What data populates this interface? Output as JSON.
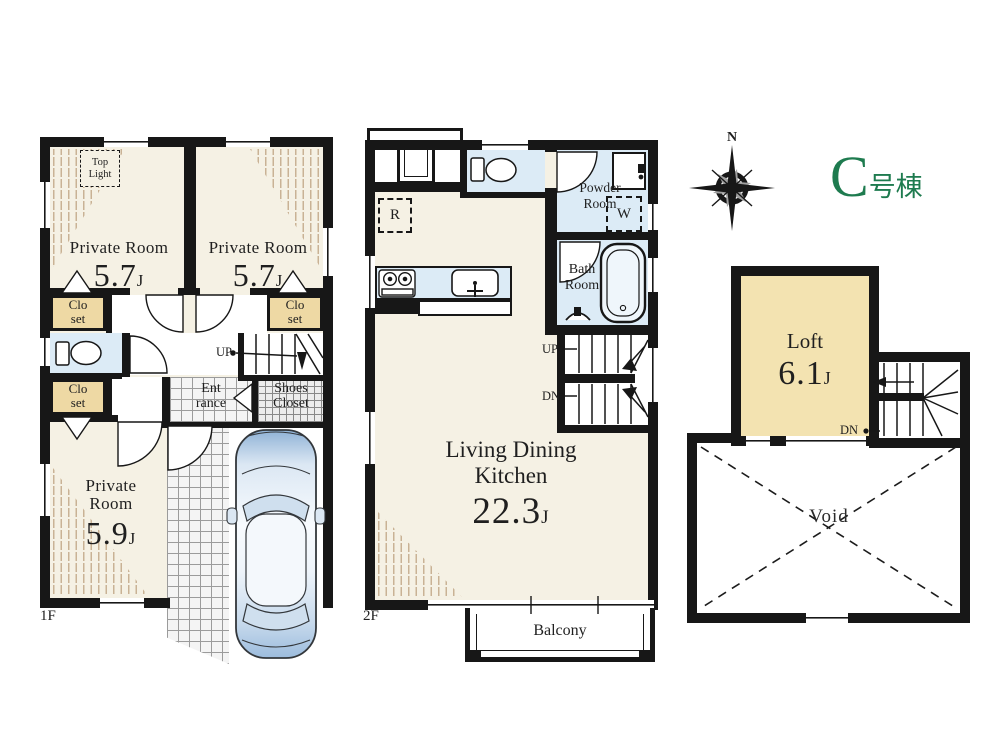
{
  "building_label": {
    "letter": "C",
    "suffix": "号棟"
  },
  "compass": {
    "north": "N"
  },
  "floor1": {
    "label": "1F",
    "private_room_a": {
      "name": "Private Room",
      "size": "5.7",
      "unit": "J"
    },
    "private_room_b": {
      "name": "Private Room",
      "size": "5.7",
      "unit": "J"
    },
    "private_room_c": {
      "name_line1": "Private",
      "name_line2": "Room",
      "size": "5.9",
      "unit": "J"
    },
    "top_light": {
      "line1": "Top",
      "line2": "Light"
    },
    "closet": {
      "line1": "Clo",
      "line2": "set"
    },
    "entrance": {
      "line1": "Ent",
      "line2": "rance"
    },
    "shoes_closet": {
      "line1": "Shoes",
      "line2": "Closet"
    },
    "stairs_up": "UP"
  },
  "floor2": {
    "label": "2F",
    "ldk": {
      "name_line1": "Living Dining",
      "name_line2": "Kitchen",
      "size": "22.3",
      "unit": "J"
    },
    "powder_room": {
      "line1": "Powder",
      "line2": "Room"
    },
    "bath_room": {
      "line1": "Bath",
      "line2": "Room"
    },
    "refrigerator": "R",
    "washing_machine": "W",
    "stairs_up": "UP",
    "stairs_down": "DN",
    "balcony": "Balcony"
  },
  "loft": {
    "room": {
      "name": "Loft",
      "size": "6.1",
      "unit": "J"
    },
    "stairs_down": "DN",
    "void": "Void"
  },
  "colors": {
    "wall": "#171717",
    "room_floor": "#f5f1e4",
    "closet_fill": "#eed9a4",
    "loft_fill": "#f3e3b1",
    "wet_room": "#dcebf6",
    "accent_green": "#1e7b4f"
  }
}
